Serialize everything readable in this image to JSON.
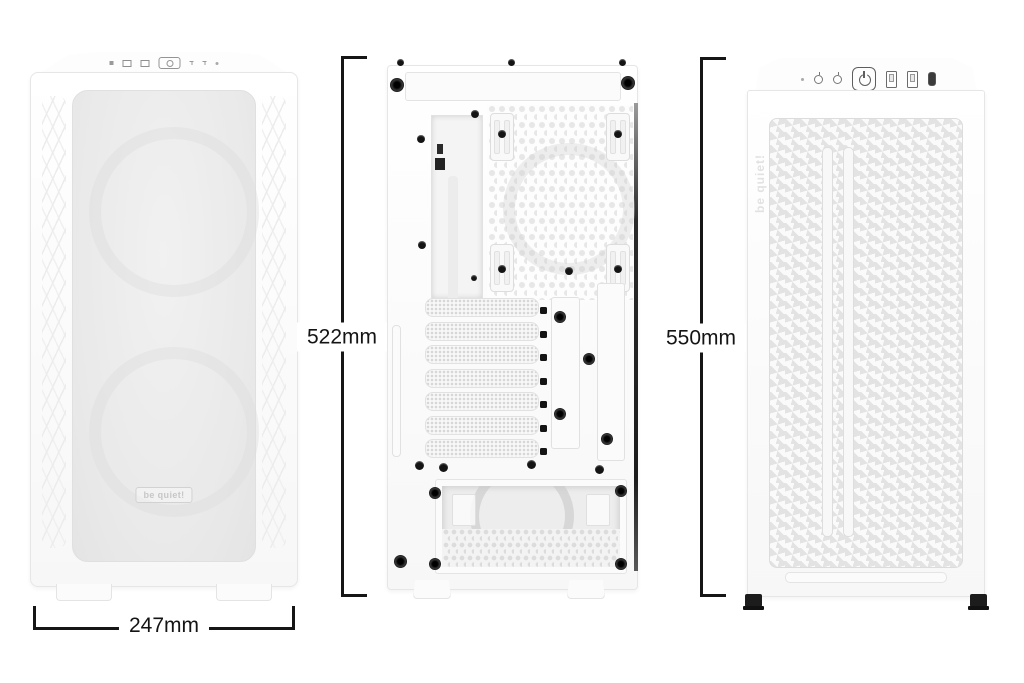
{
  "dimensions": {
    "width": {
      "label": "247mm"
    },
    "rear_height": {
      "label": "522mm"
    },
    "front_height": {
      "label": "550mm"
    }
  },
  "branding": {
    "logo_front": "be quiet!",
    "logo_side": "be quiet!"
  },
  "colors": {
    "background": "#ffffff",
    "dimension_line": "#161616",
    "case_body": "#fdfdfd",
    "panel_border": "#e6e6e6",
    "mesh_fill": "#ececec",
    "screw": "#141414"
  },
  "icons": {
    "power_icon": "power symbol in rounded square",
    "usb_a_icon": "USB-A port rectangle",
    "usb_c_icon": "USB-C port pill",
    "audio_jack_icon": "3.5mm audio jack circle",
    "led_icon": "small status dot"
  }
}
